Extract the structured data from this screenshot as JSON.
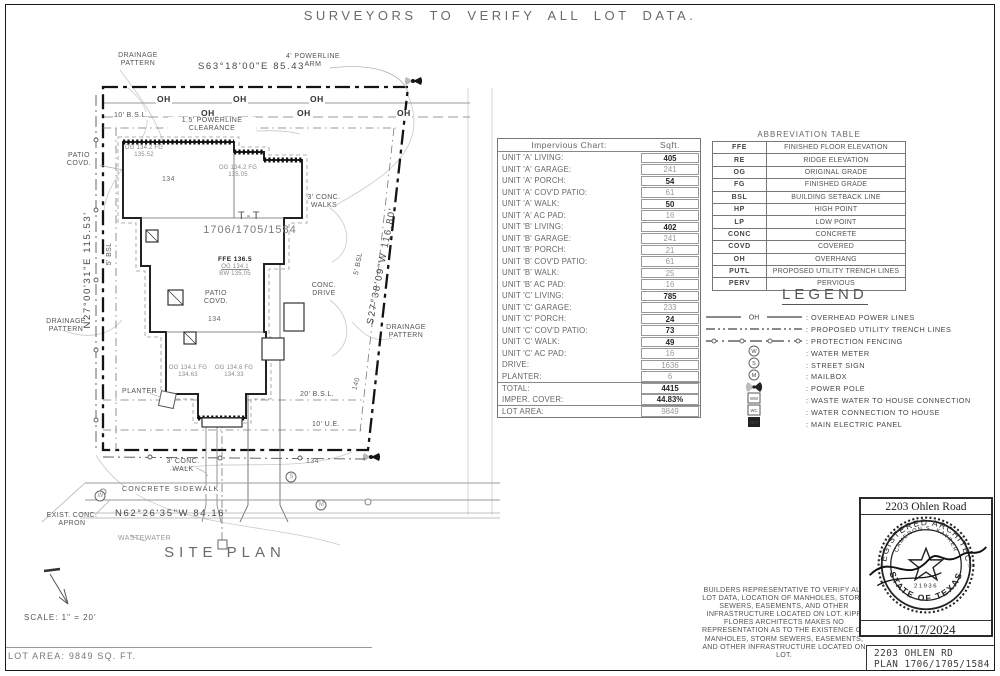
{
  "page": {
    "title": "SURVEYORS TO VERIFY ALL LOT DATA.",
    "footer": {
      "lot_area": "LOT AREA: 9849 SQ. FT.",
      "address": "2203 OHLEN RD",
      "plan": "PLAN 1706/1705/1584"
    }
  },
  "site_plan": {
    "heading": "SITE PLAN",
    "scale": "SCALE: 1\" = 20'",
    "bearings": {
      "top": "S63°18'00\"E  85.43'",
      "left": "N27°00'31\"E  115.53'",
      "right": "S27°38'09\"W  116.80'",
      "bottom": "N62°26'35\"W  84.16'"
    },
    "labels": {
      "oh": "OH",
      "drainage_pattern": "DRAINAGE PATTERN",
      "powerline_arm": "4' POWERLINE ARM",
      "powerline_clearance": "1.5' POWERLINE CLEARANCE",
      "bsl10": "10' B.S.L.",
      "bsl5_left": "5' BSL",
      "bsl5_right": "5' BSL",
      "bsl20": "20' B.S.L.",
      "ue10": "10' U.E.",
      "patio_covd": "PATIO COVD.",
      "building_name": "T-T",
      "building_plans": "1706/1705/1584",
      "ffe": "FFE 136.5",
      "og_main": "OG 134.1",
      "bw_main": "BW 135.05",
      "grade_note_1": "OG 134.2 FG 135.52",
      "grade_note_2": "OG 134.2 FG 135.05",
      "grade_note_3": "OG 134.1 FG 134.63",
      "grade_note_4": "OG 134.6 FG 134.33",
      "elev_134": "134",
      "contour_140": "140",
      "conc_walks": "3' CONC. WALKS",
      "conc_drive": "CONC. DRIVE",
      "conc_walk": "3' CONC. WALK",
      "planter": "PLANTER",
      "sidewalk": "CONCRETE SIDEWALK",
      "apron": "EXIST. CONC. APRON",
      "wastewater": "WASTEWATER"
    }
  },
  "impervious_chart": {
    "title": "Impervious Chart:",
    "unit_header": "Sqft.",
    "rows": [
      {
        "label": "UNIT 'A' LIVING:",
        "value": "405",
        "strong": true
      },
      {
        "label": "UNIT 'A' GARAGE:",
        "value": "241"
      },
      {
        "label": "UNIT 'A' PORCH:",
        "value": "54",
        "strong": true
      },
      {
        "label": "UNIT 'A' COV'D PATIO:",
        "value": "61"
      },
      {
        "label": "UNIT 'A' WALK:",
        "value": "50",
        "strong": true
      },
      {
        "label": "UNIT 'A' AC PAD:",
        "value": "16"
      },
      {
        "label": "UNIT 'B' LIVING:",
        "value": "402",
        "strong": true
      },
      {
        "label": "UNIT 'B' GARAGE:",
        "value": "241"
      },
      {
        "label": "UNIT 'B' PORCH:",
        "value": "21"
      },
      {
        "label": "UNIT 'B' COV'D PATIO:",
        "value": "61"
      },
      {
        "label": "UNIT 'B' WALK:",
        "value": "25"
      },
      {
        "label": "UNIT 'B' AC PAD:",
        "value": "16"
      },
      {
        "label": "UNIT 'C' LIVING:",
        "value": "785",
        "strong": true
      },
      {
        "label": "UNIT 'C' GARAGE:",
        "value": "233"
      },
      {
        "label": "UNIT 'C' PORCH:",
        "value": "24",
        "strong": true
      },
      {
        "label": "UNIT 'C' COV'D PATIO:",
        "value": "73",
        "strong": true
      },
      {
        "label": "UNIT 'C' WALK:",
        "value": "49",
        "strong": true
      },
      {
        "label": "UNIT 'C' AC PAD:",
        "value": "16"
      },
      {
        "label": "DRIVE:",
        "value": "1636"
      },
      {
        "label": "PLANTER:",
        "value": "6"
      },
      {
        "label": "TOTAL:",
        "value": "4415",
        "strong": true,
        "section_break": true
      },
      {
        "label": "IMPER. COVER:",
        "value": "44.83%",
        "strong": true
      },
      {
        "label": "LOT AREA:",
        "value": "9849",
        "section_break": true
      }
    ]
  },
  "abbreviation_table": {
    "title": "ABBREVIATION TABLE",
    "rows": [
      {
        "abbr": "FFE",
        "meaning": "FINISHED FLOOR ELEVATION"
      },
      {
        "abbr": "RE",
        "meaning": "RIDGE ELEVATION"
      },
      {
        "abbr": "OG",
        "meaning": "ORIGINAL GRADE"
      },
      {
        "abbr": "FG",
        "meaning": "FINISHED GRADE"
      },
      {
        "abbr": "BSL",
        "meaning": "BUILDING SETBACK LINE"
      },
      {
        "abbr": "HP",
        "meaning": "HIGH POINT"
      },
      {
        "abbr": "LP",
        "meaning": "LOW POINT"
      },
      {
        "abbr": "CONC",
        "meaning": "CONCRETE"
      },
      {
        "abbr": "COVD",
        "meaning": "COVERED"
      },
      {
        "abbr": "OH",
        "meaning": "OVERHANG"
      },
      {
        "abbr": "PUTL",
        "meaning": "PROPOSED UTILITY TRENCH LINES"
      },
      {
        "abbr": "PERV",
        "meaning": "PERVIOUS"
      }
    ]
  },
  "legend": {
    "title": "LEGEND",
    "items": [
      {
        "symbol": "overhead-line",
        "label": "OVERHEAD POWER LINES"
      },
      {
        "symbol": "trench-line",
        "label": "PROPOSED UTILITY TRENCH LINES"
      },
      {
        "symbol": "fence-line",
        "label": "PROTECTION FENCING"
      },
      {
        "symbol": "circle-symbol",
        "letter": "W",
        "label": "WATER METER"
      },
      {
        "symbol": "circle-symbol",
        "letter": "S",
        "label": "STREET SIGN"
      },
      {
        "symbol": "circle-symbol",
        "letter": "M",
        "label": "MAILBOX"
      },
      {
        "symbol": "power-pole",
        "label": "POWER POLE"
      },
      {
        "symbol": "box-symbol",
        "letter": "WW",
        "label": "WASTE WATER TO HOUSE CONNECTION"
      },
      {
        "symbol": "box-symbol",
        "letter": "WC",
        "label": "WATER CONNECTION TO HOUSE"
      },
      {
        "symbol": "box-symbol-filled",
        "letter": "MEP",
        "label": "MAIN ELECTRIC PANEL"
      }
    ]
  },
  "notes": {
    "builder": "BUILDERS REPRESENTATIVE TO VERIFY ALL LOT DATA, LOCATION OF MANHOLES, STORM SEWERS, EASEMENTS, AND OTHER INFRASTRUCTURE LOCATED ON LOT. KIPP FLORES ARCHITECTS MAKES NO REPRESENTATION AS TO THE EXISTENCE OF MANHOLES, STORM SEWERS, EASEMENTS, AND OTHER INFRASTRUCTURE LOCATED ON LOT."
  },
  "stamp": {
    "address": "2203 Ohlen Road",
    "arc_top": "REGISTERED ARCHITECT",
    "arc_bottom": "STATE OF TEXAS",
    "name": "CAMERON S. KAYRER",
    "number": "21936",
    "date": "10/17/2024"
  }
}
